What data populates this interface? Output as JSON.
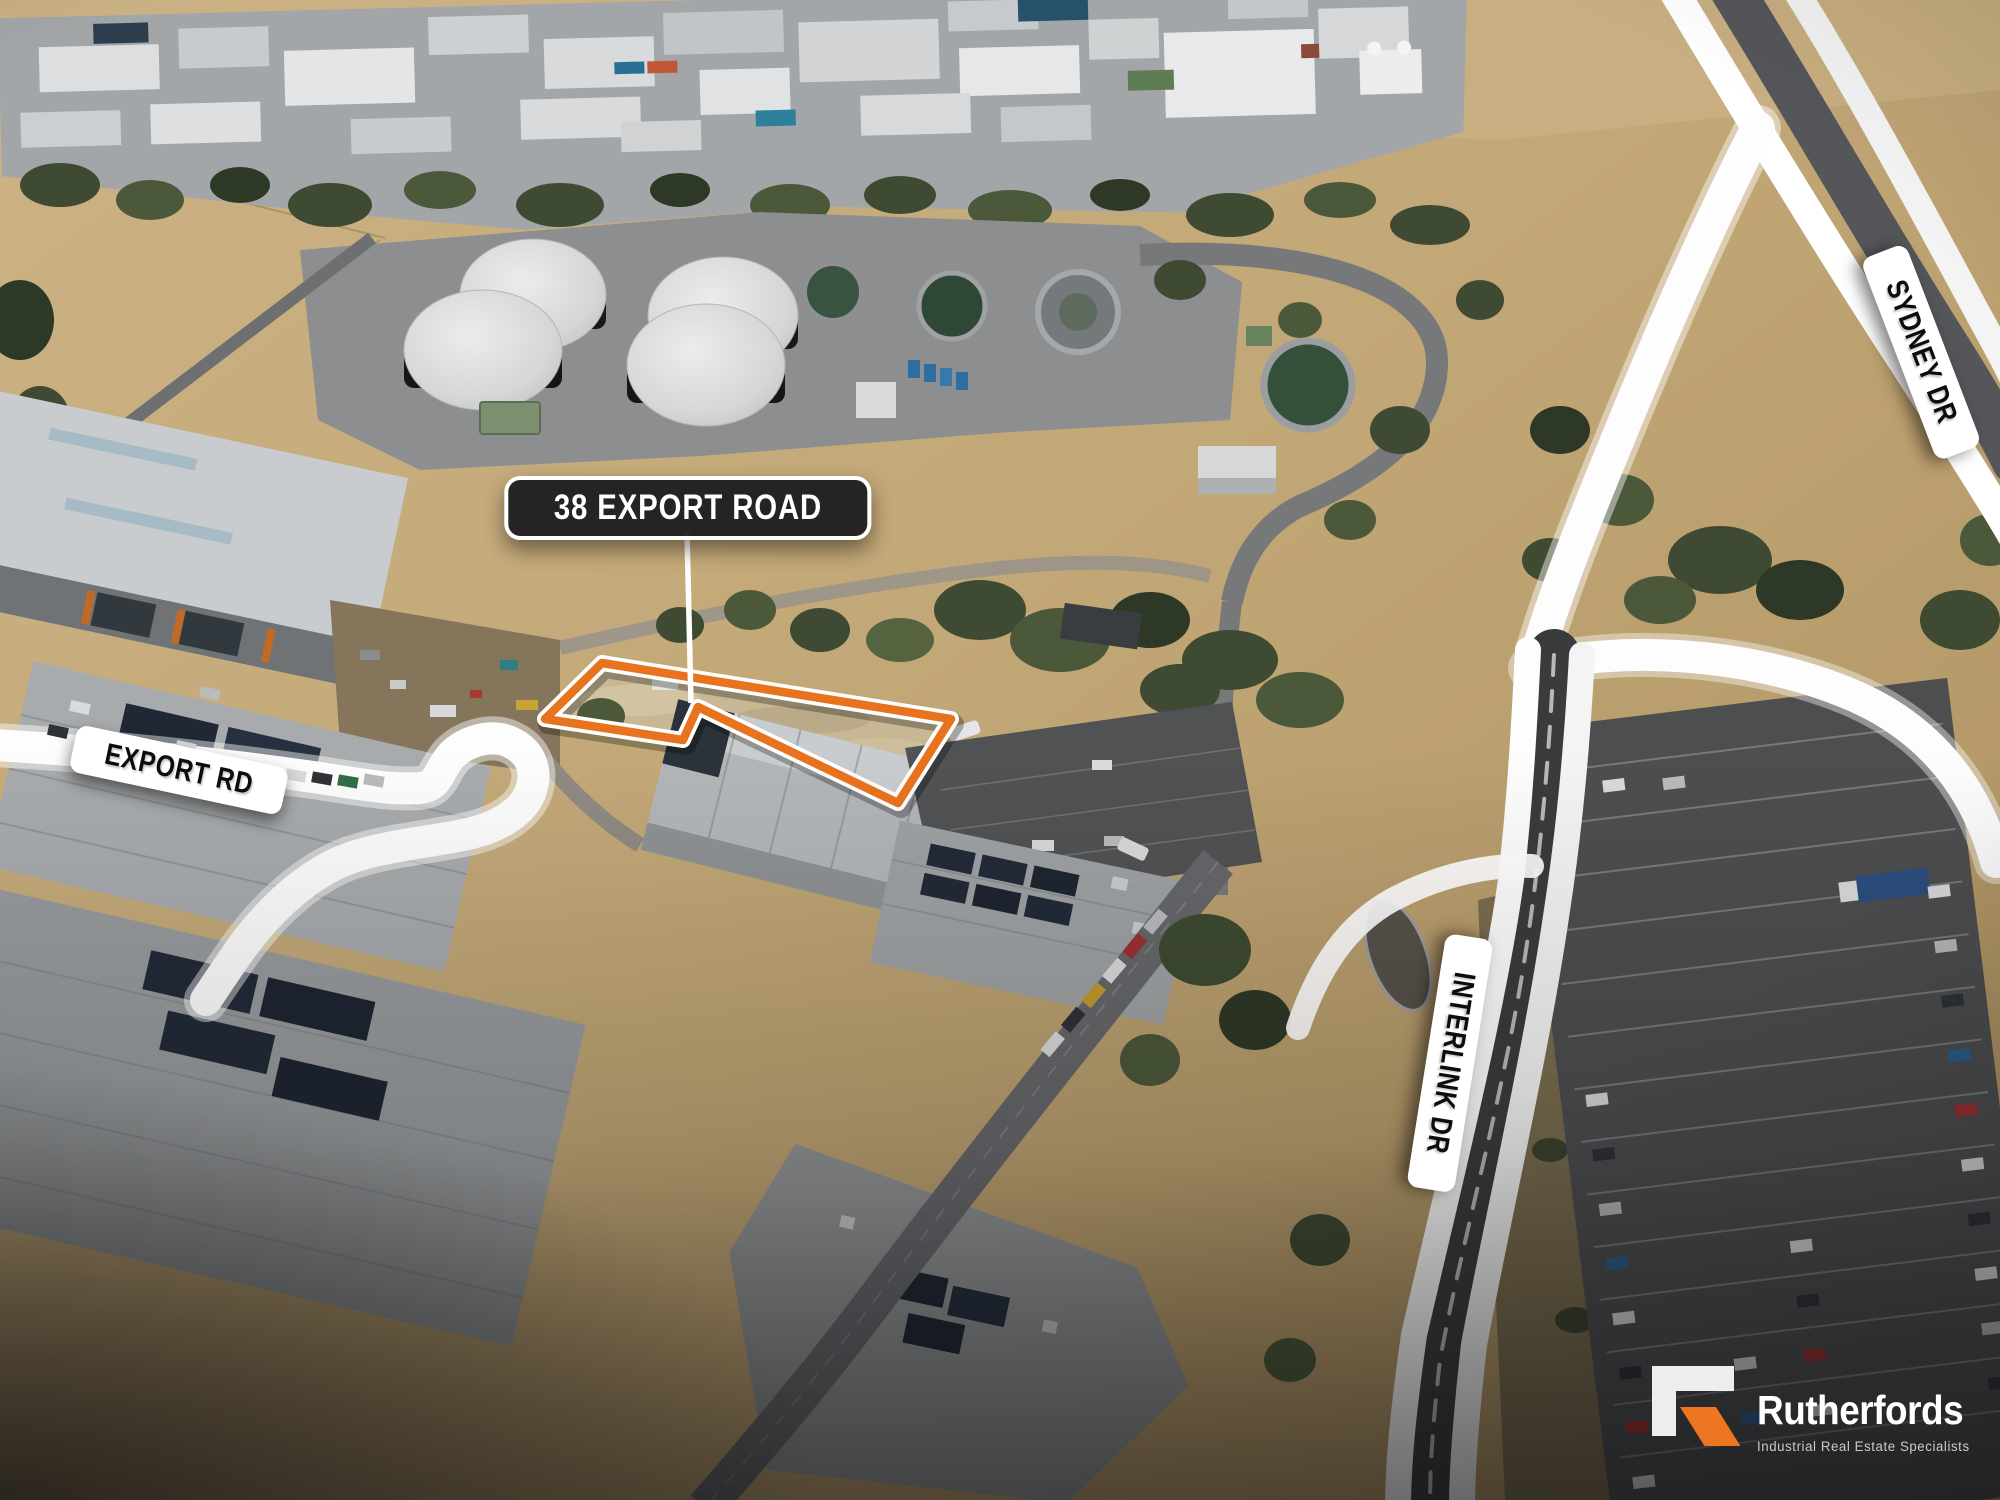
{
  "callout": {
    "label": "38 EXPORT ROAD"
  },
  "road_labels": [
    {
      "id": "export-rd",
      "label": "EXPORT RD"
    },
    {
      "id": "sydney-dr",
      "label": "SYDNEY DR"
    },
    {
      "id": "interlink-dr",
      "label": "INTERLINK DR"
    }
  ],
  "site_boundary": {
    "outline_color": "#e8731e",
    "inner_line_color": "#ffffff"
  },
  "logo": {
    "brand": "Rutherfords",
    "tagline": "Industrial Real Estate Specialists",
    "accent_color": "#ee7623",
    "mark_color": "#ededee",
    "mark_icon": "rutherfords-r-mark"
  },
  "colors": {
    "overlay_road": "#ffffff",
    "callout_bg": "#1c1c1e",
    "label_bg": "#ffffff",
    "label_text": "#0c0c0d"
  }
}
